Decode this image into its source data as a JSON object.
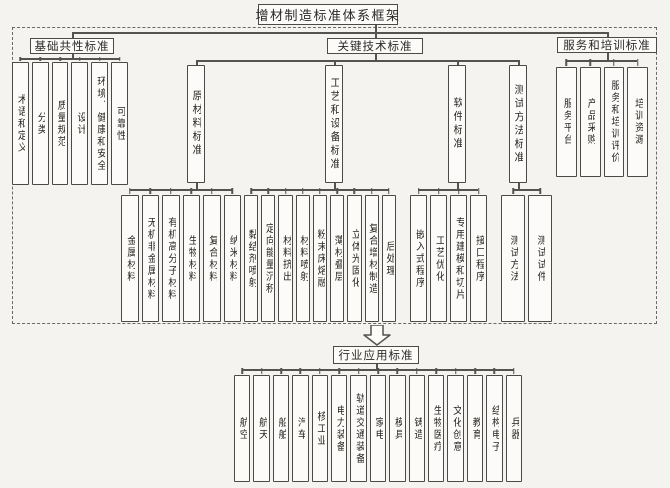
{
  "colors": {
    "bg": "#f5f3f0",
    "box-fill": "#fcfbf9",
    "box-border": "#4c4a47",
    "line": "#55534f",
    "text": "#2b2926"
  },
  "title": "增材制造标准体系框架",
  "branches": {
    "basic": {
      "label": "基础共性标准",
      "children": [
        "术语和定义",
        "分类",
        "质量规范",
        "设计",
        "环境、健康和安全",
        "可靠性"
      ]
    },
    "key": {
      "label": "关键技术标准",
      "groups": [
        {
          "label": "原材料标准",
          "children": [
            "金属材料",
            "无机非金属材料",
            "有机高分子材料",
            "生物材料",
            "复合材料",
            "纳米材料"
          ]
        },
        {
          "label": "工艺和设备标准",
          "children": [
            "黏结剂喷射",
            "定向能量沉积",
            "材料挤出",
            "材料喷射",
            "粉末床熔融",
            "薄材叠层",
            "立体光固化",
            "复合增材制造",
            "后处理"
          ]
        },
        {
          "label": "软件标准",
          "children": [
            "嵌入式程序",
            "工艺优化",
            "专用建模和切片",
            "接口程序"
          ]
        },
        {
          "label": "测试方法标准",
          "children": [
            "测试方法",
            "测试试件"
          ]
        }
      ]
    },
    "service": {
      "label": "服务和培训标准",
      "children": [
        "服务平台",
        "产品采购",
        "服务和培训评价",
        "培训资源"
      ]
    }
  },
  "industry": {
    "label": "行业应用标准",
    "children": [
      "航空",
      "航天",
      "船舶",
      "汽车",
      "核工业",
      "电力装备",
      "轨道交通装备",
      "家电",
      "模具",
      "铸造",
      "生物医疗",
      "文化创意",
      "教育",
      "结构电子",
      "兵器"
    ]
  },
  "icons": {
    "down_arrow": "hollow-down-arrow"
  }
}
